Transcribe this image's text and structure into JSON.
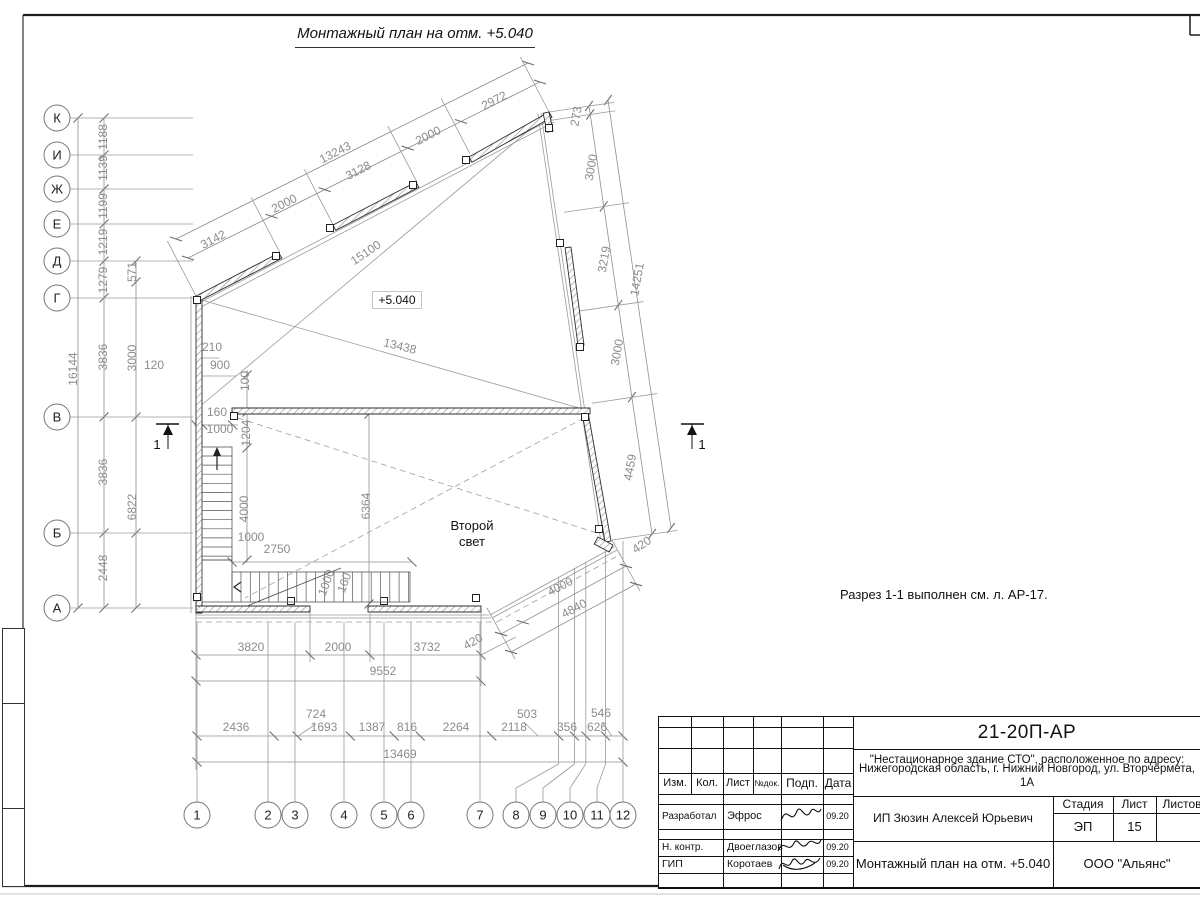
{
  "title": "Монтажный план на отм. +5.040",
  "note": "Разрез 1-1 выполнен см. л. АР-17.",
  "plan": {
    "elevation": "+5.040",
    "room_line1": "Второй",
    "room_line2": "свет",
    "section": "1"
  },
  "axes_left": [
    "К",
    "И",
    "Ж",
    "Е",
    "Д",
    "Г",
    "В",
    "Б",
    "А"
  ],
  "axes_bottom": [
    "1",
    "2",
    "3",
    "4",
    "5",
    "6",
    "7",
    "8",
    "9",
    "10",
    "11",
    "12"
  ],
  "dims": [
    {
      "t": "3142",
      "x": 215,
      "y": 243,
      "r": -27
    },
    {
      "t": "2000",
      "x": 286,
      "y": 207,
      "r": -27
    },
    {
      "t": "3128",
      "x": 360,
      "y": 174,
      "r": -27
    },
    {
      "t": "2000",
      "x": 430,
      "y": 139,
      "r": -27
    },
    {
      "t": "2972",
      "x": 496,
      "y": 104,
      "r": -27
    },
    {
      "t": "13243",
      "x": 337,
      "y": 156,
      "r": -27
    },
    {
      "t": "15100",
      "x": 368,
      "y": 256,
      "r": -34
    },
    {
      "t": "13438",
      "x": 399,
      "y": 350,
      "r": 14
    },
    {
      "t": "1188",
      "x": 107,
      "y": 137,
      "r": -90
    },
    {
      "t": "1139",
      "x": 107,
      "y": 168,
      "r": -90
    },
    {
      "t": "1199",
      "x": 107,
      "y": 206,
      "r": -90
    },
    {
      "t": "1219",
      "x": 107,
      "y": 242,
      "r": -90
    },
    {
      "t": "1279",
      "x": 107,
      "y": 280,
      "r": -90
    },
    {
      "t": "571",
      "x": 136,
      "y": 272,
      "r": -90
    },
    {
      "t": "16144",
      "x": 77,
      "y": 369,
      "r": -90
    },
    {
      "t": "3836",
      "x": 107,
      "y": 357,
      "r": -90
    },
    {
      "t": "3000",
      "x": 136,
      "y": 358,
      "r": -90
    },
    {
      "t": "120",
      "x": 154,
      "y": 369,
      "r": 0
    },
    {
      "t": "3836",
      "x": 107,
      "y": 472,
      "r": -90
    },
    {
      "t": "6822",
      "x": 136,
      "y": 507,
      "r": -90
    },
    {
      "t": "2448",
      "x": 107,
      "y": 568,
      "r": -90
    },
    {
      "t": "210",
      "x": 212,
      "y": 351,
      "r": 0
    },
    {
      "t": "900",
      "x": 220,
      "y": 369,
      "r": 0
    },
    {
      "t": "100",
      "x": 249,
      "y": 381,
      "r": -90
    },
    {
      "t": "160",
      "x": 217,
      "y": 416,
      "r": 0
    },
    {
      "t": "1000",
      "x": 220,
      "y": 433,
      "r": 0
    },
    {
      "t": "1204",
      "x": 250,
      "y": 433,
      "r": -90
    },
    {
      "t": "4000",
      "x": 248,
      "y": 509,
      "r": -90
    },
    {
      "t": "1000",
      "x": 251,
      "y": 541,
      "r": 0
    },
    {
      "t": "2750",
      "x": 277,
      "y": 553,
      "r": 0
    },
    {
      "t": "6364",
      "x": 370,
      "y": 506,
      "r": -90
    },
    {
      "t": "1000",
      "x": 330,
      "y": 584,
      "r": -70
    },
    {
      "t": "160",
      "x": 348,
      "y": 584,
      "r": -70
    },
    {
      "t": "273",
      "x": 580,
      "y": 117,
      "r": -80
    },
    {
      "t": "3000",
      "x": 595,
      "y": 168,
      "r": -80
    },
    {
      "t": "3219",
      "x": 608,
      "y": 260,
      "r": -80
    },
    {
      "t": "14251",
      "x": 641,
      "y": 280,
      "r": -80
    },
    {
      "t": "3000",
      "x": 621,
      "y": 353,
      "r": -80
    },
    {
      "t": "4459",
      "x": 634,
      "y": 468,
      "r": -80
    },
    {
      "t": "420",
      "x": 644,
      "y": 548,
      "r": -35
    },
    {
      "t": "4000",
      "x": 562,
      "y": 590,
      "r": -28
    },
    {
      "t": "4840",
      "x": 576,
      "y": 612,
      "r": -28
    },
    {
      "t": "420",
      "x": 475,
      "y": 645,
      "r": -30
    },
    {
      "t": "3820",
      "x": 251,
      "y": 651,
      "r": 0
    },
    {
      "t": "2000",
      "x": 338,
      "y": 651,
      "r": 0
    },
    {
      "t": "3732",
      "x": 427,
      "y": 651,
      "r": 0
    },
    {
      "t": "9552",
      "x": 383,
      "y": 675,
      "r": 0
    },
    {
      "t": "2436",
      "x": 236,
      "y": 731,
      "r": 0
    },
    {
      "t": "724",
      "x": 316,
      "y": 718,
      "r": 0
    },
    {
      "t": "1693",
      "x": 324,
      "y": 731,
      "r": 0
    },
    {
      "t": "1387",
      "x": 372,
      "y": 731,
      "r": 0
    },
    {
      "t": "816",
      "x": 407,
      "y": 731,
      "r": 0
    },
    {
      "t": "2264",
      "x": 456,
      "y": 731,
      "r": 0
    },
    {
      "t": "2118",
      "x": 514,
      "y": 731,
      "r": 0
    },
    {
      "t": "503",
      "x": 527,
      "y": 718,
      "r": 0
    },
    {
      "t": "356",
      "x": 567,
      "y": 731,
      "r": 0
    },
    {
      "t": "626",
      "x": 597,
      "y": 731,
      "r": 0
    },
    {
      "t": "546",
      "x": 601,
      "y": 717,
      "r": 0
    },
    {
      "t": "13469",
      "x": 400,
      "y": 758,
      "r": 0
    }
  ],
  "title_block": {
    "doc_number": "21-20П-АР",
    "project_line1": "\"Нестационарное здание СТО\", расположенное по адресу:",
    "project_line2": "Нижегородская область, г. Нижний Новгород, ул. Вторчермета, 1А",
    "client": "ИП Зюзин Алексей Юрьевич",
    "sheet_title": "Монтажный план на отм. +5.040",
    "company": "ООО \"Альянс\"",
    "stage_label": "Стадия",
    "sheet_label": "Лист",
    "sheets_label": "Листов",
    "stage": "ЭП",
    "sheet_number": "15",
    "cols": [
      "Изм.",
      "Кол.",
      "Лист",
      "№док.",
      "Подп.",
      "Дата"
    ],
    "rows": [
      {
        "role": "Разработал",
        "name": "Эфрос",
        "date": "09.20"
      },
      {
        "role": "Н. контр.",
        "name": "Двоеглазов",
        "date": "09.20"
      },
      {
        "role": "ГИП",
        "name": "Коротаев",
        "date": "09.20"
      }
    ]
  }
}
